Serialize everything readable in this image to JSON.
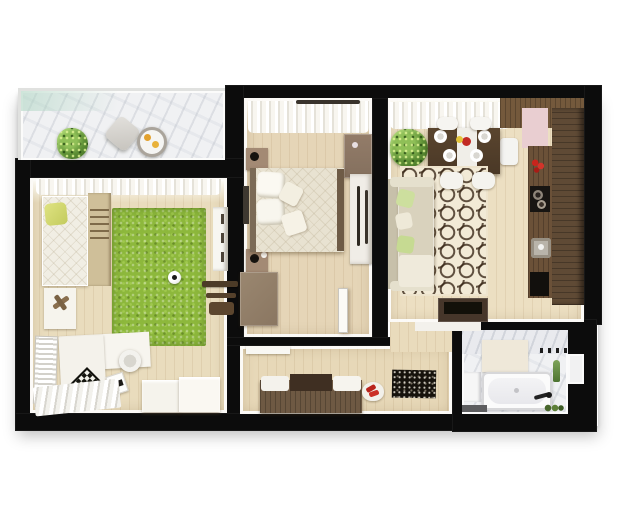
{
  "image": {
    "kind": "3d-rendered apartment floor plan, top-down view",
    "background_color": "#ffffff",
    "wall_color": "#0c0c0c"
  },
  "palette": {
    "wood_floor": "#e8dbbc",
    "marble_floor": "#f0f1f3",
    "green_rug": "#8db83c",
    "lattice_rug_base": "#f2ead6",
    "lattice_rug_line": "#3c2a1a",
    "dark_wood": "#5e4936",
    "sofa_beige": "#d9d2bd",
    "pillow_green": "#cddf9e",
    "pink_wall": "#e9ced1",
    "curtain_white": "#f8f6f0"
  },
  "rooms": {
    "balcony": {
      "name": "balcony",
      "items": [
        "potted-plant",
        "floor-cushion",
        "round-tray-table"
      ]
    },
    "kids_room": {
      "name": "kids-room",
      "items": [
        "bed-with-yellow-pillow",
        "ladder-shelf",
        "green-rug",
        "soccer-ball",
        "white-dresser",
        "wall-bars",
        "toy-table",
        "corner-desk",
        "chessboard",
        "desk-chair",
        "storage-boxes",
        "radiator-shelf",
        "striped-rug"
      ]
    },
    "bedroom": {
      "name": "bedroom",
      "items": [
        "curtains",
        "double-bed",
        "nightstand",
        "nightstand",
        "wardrobe",
        "dresser",
        "corner-desk",
        "door-leaf"
      ]
    },
    "living_kitchen": {
      "name": "living-room-kitchen",
      "items": [
        "curtains",
        "potted-plant",
        "dining-table",
        "chairs",
        "plates",
        "patterned-rug",
        "sofa-with-green-pillows",
        "tv-stand",
        "kitchen-counter",
        "stove",
        "sink",
        "tall-cabinets",
        "fridge"
      ]
    },
    "hallway": {
      "name": "hallway",
      "items": [
        "shoe-bench",
        "cushions",
        "red-shoes",
        "doormat",
        "wall-shelf"
      ]
    },
    "bathroom": {
      "name": "bathroom",
      "items": [
        "bathtub",
        "vanity",
        "towel-shelf",
        "towel-hooks",
        "faucet",
        "plant-sprig",
        "bath-mat",
        "bottles"
      ]
    }
  }
}
